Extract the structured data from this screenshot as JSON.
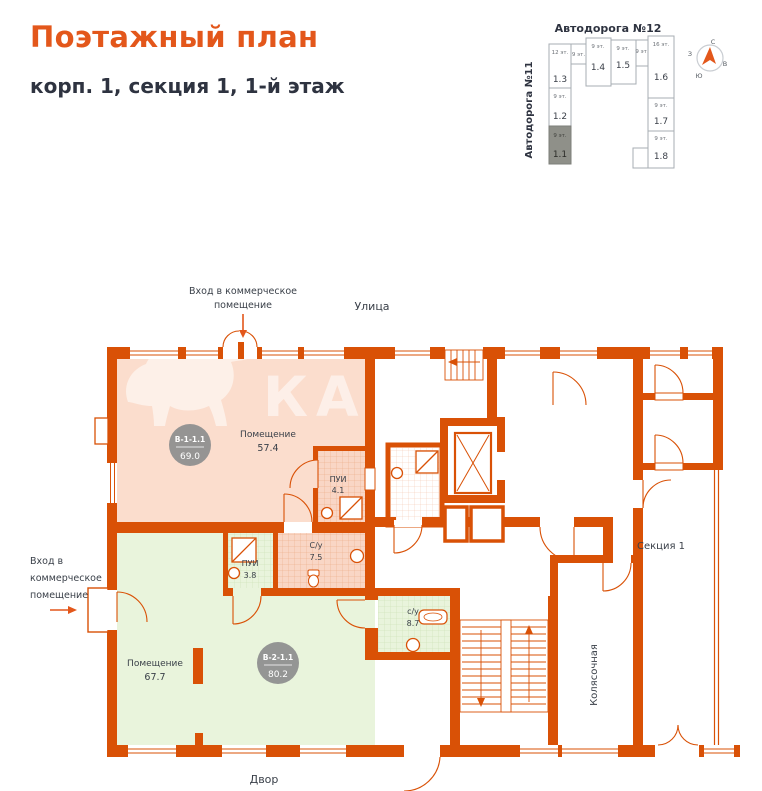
{
  "header": {
    "title": "Поэтажный план",
    "subtitle": "корп. 1, секция 1, 1-й этаж"
  },
  "minimap": {
    "road_top": "Автодорога №12",
    "road_left": "Автодорога №11",
    "compass": {
      "n": "С",
      "e": "В",
      "s": "Ю",
      "w": "З"
    },
    "sections": [
      {
        "id": "1.1",
        "floors": "9 эт.",
        "highlighted": true
      },
      {
        "id": "1.2",
        "floors": "9 эт."
      },
      {
        "id": "1.3",
        "floors": "12 эт."
      },
      {
        "id": "1.4",
        "floors": "9 эт."
      },
      {
        "id": "1.5",
        "floors": "9 эт."
      },
      {
        "id": "1.6",
        "floors": "16 эт."
      },
      {
        "id": "1.7",
        "floors": "9 эт."
      },
      {
        "id": "1.8",
        "floors": "9 эт."
      }
    ],
    "fillers": [
      "9 эт.",
      "9 эт."
    ]
  },
  "plan": {
    "street": "Улица",
    "yard": "Двор",
    "entrance_top": {
      "line1": "Вход в коммерческое",
      "line2": "помещение"
    },
    "entrance_left": {
      "line1": "Вход в",
      "line2": "коммерческое",
      "line3": "помещение"
    },
    "section": "Секция 1",
    "stroller": "Колясочная",
    "watermark": "КАГА",
    "units": [
      {
        "id": "В-1-1.1",
        "total": "69.0",
        "room": "Помещение",
        "room_area": "57.4"
      },
      {
        "id": "В-2-1.1",
        "total": "80.2",
        "room": "Помещение",
        "room_area": "67.7"
      }
    ],
    "wet_rooms": [
      {
        "label": "ПУИ",
        "area": "4.1"
      },
      {
        "label": "С/у",
        "area": "7.5"
      },
      {
        "label": "ПУИ",
        "area": "3.8"
      },
      {
        "label": "с/у",
        "area": "8.7"
      }
    ]
  },
  "colors": {
    "accent": "#E3571B",
    "wall": "#D95106",
    "unit_commercial": "#FBDDCD",
    "unit_commercial2": "#E9F4DC",
    "badge": "#8F8F8F",
    "text": "#3A4049"
  }
}
